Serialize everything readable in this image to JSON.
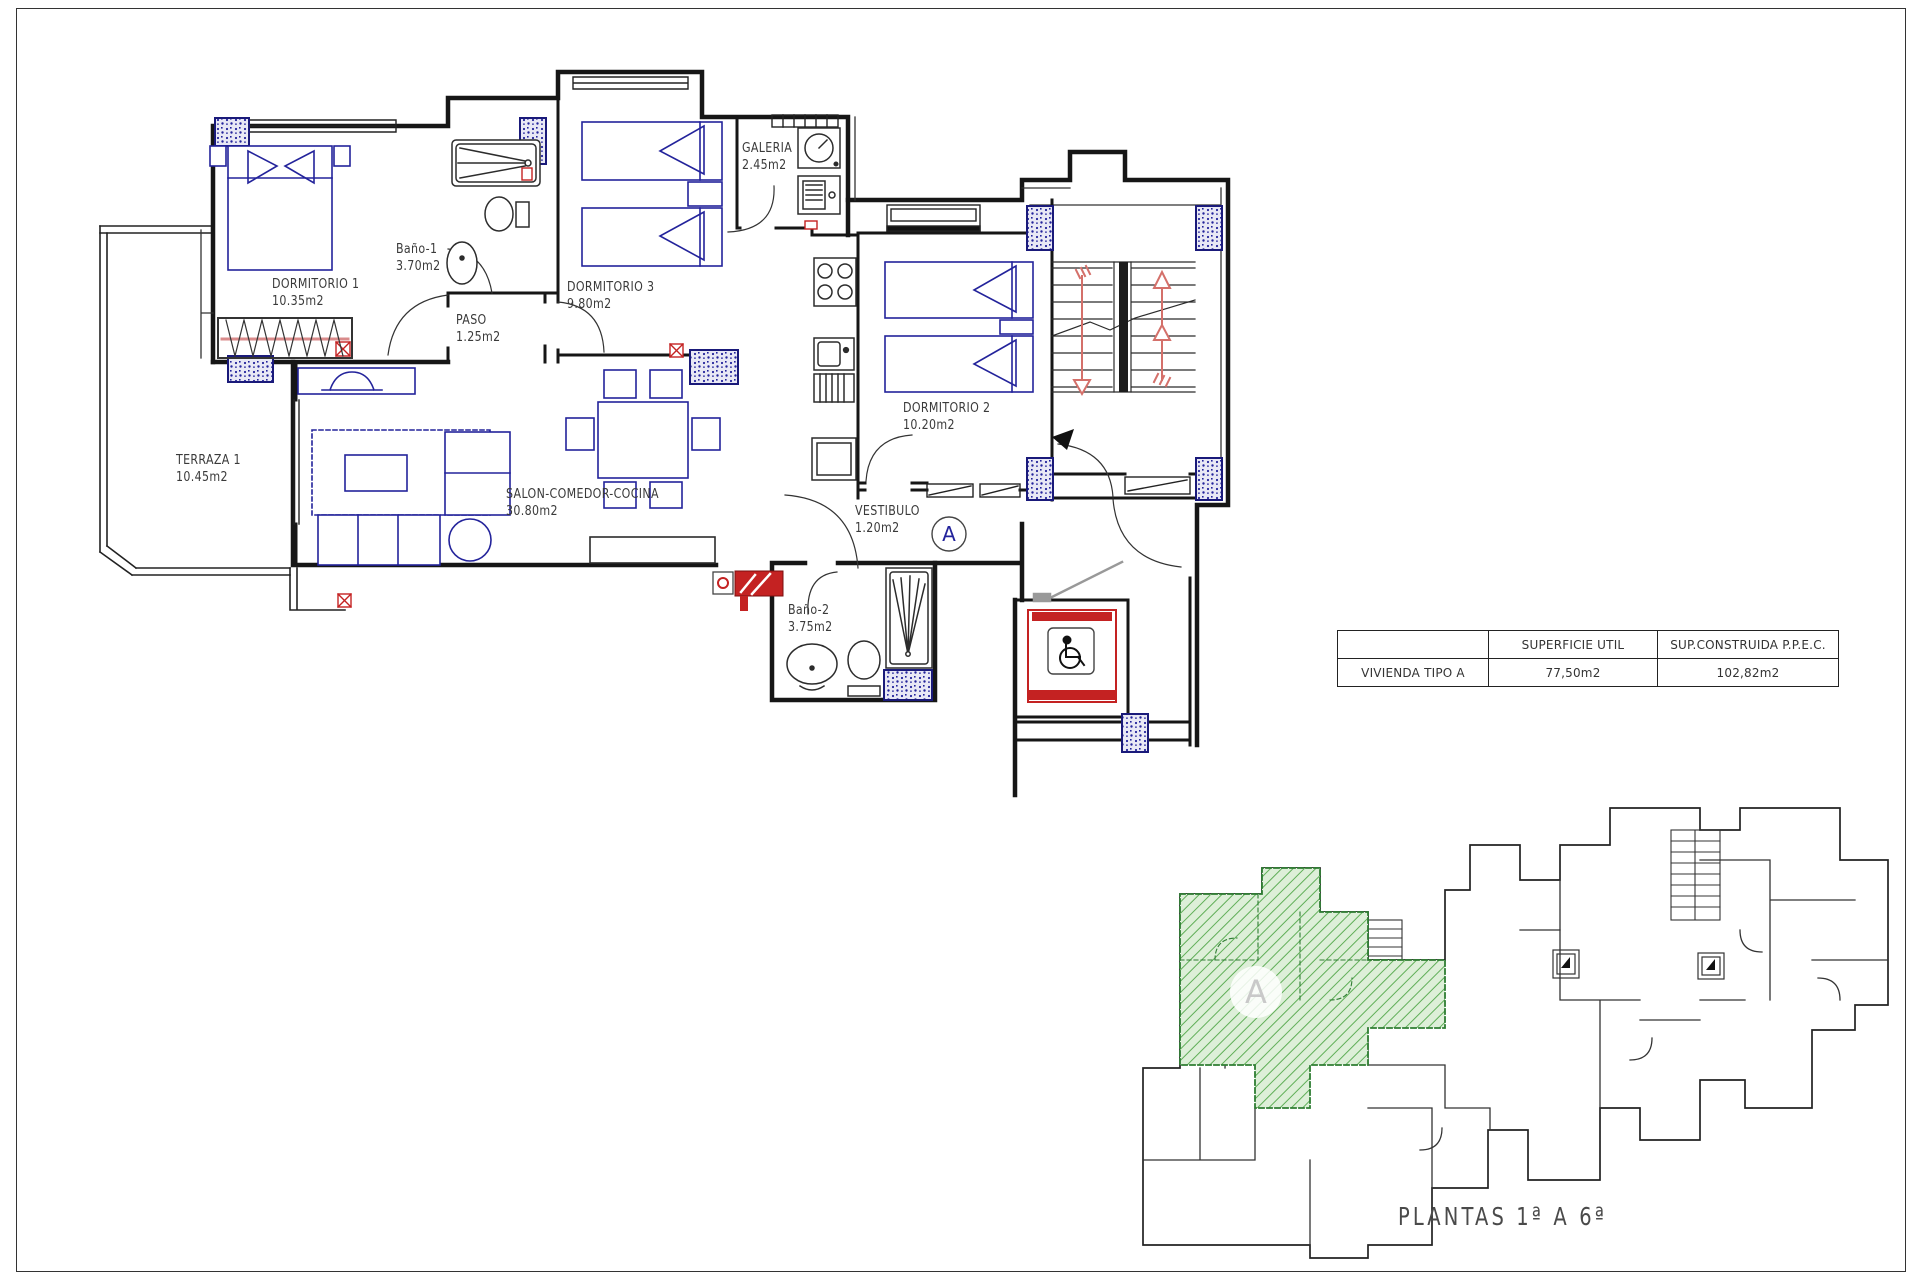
{
  "plan": {
    "unit_marker": "A",
    "rooms": [
      {
        "id": "dormitorio1",
        "name": "DORMITORIO 1",
        "area": "10.35m2"
      },
      {
        "id": "bano1",
        "name": "Baño-1",
        "area": "3.70m2"
      },
      {
        "id": "paso",
        "name": "PASO",
        "area": "1.25m2"
      },
      {
        "id": "dormitorio3",
        "name": "DORMITORIO 3",
        "area": "9.80m2"
      },
      {
        "id": "galeria",
        "name": "GALERIA",
        "area": "2.45m2"
      },
      {
        "id": "dormitorio2",
        "name": "DORMITORIO 2",
        "area": "10.20m2"
      },
      {
        "id": "terraza1",
        "name": "TERRAZA 1",
        "area": "10.45m2"
      },
      {
        "id": "salon",
        "name": "SALON-COMEDOR-COCINA",
        "area": "30.80m2"
      },
      {
        "id": "vestibulo",
        "name": "VESTIBULO",
        "area": "1.20m2"
      },
      {
        "id": "bano2",
        "name": "Baño-2",
        "area": "3.75m2"
      }
    ]
  },
  "summary_table": {
    "col_headers": [
      "",
      "SUPERFICIE UTIL",
      "SUP.CONSTRUIDA  P.P.E.C."
    ],
    "row": {
      "label": "VIVIENDA TIPO A",
      "superficie_util": "77,50m2",
      "sup_construida": "102,82m2"
    }
  },
  "overview": {
    "unit_marker": "A",
    "caption": "PLANTAS  1ª  A  6ª"
  },
  "colors": {
    "wall": "#161616",
    "furniture_blue": "#23239b",
    "pillar_blue": "#1a1a7a",
    "accent_red": "#c42222",
    "stair_arrow": "#d4706a",
    "wardrobe_rail": "#d98b8b",
    "green_fill": "#ddefd8",
    "green_hatch": "#5fae57",
    "green_border": "#2e7d32",
    "label_text": "#3a3a3a"
  }
}
